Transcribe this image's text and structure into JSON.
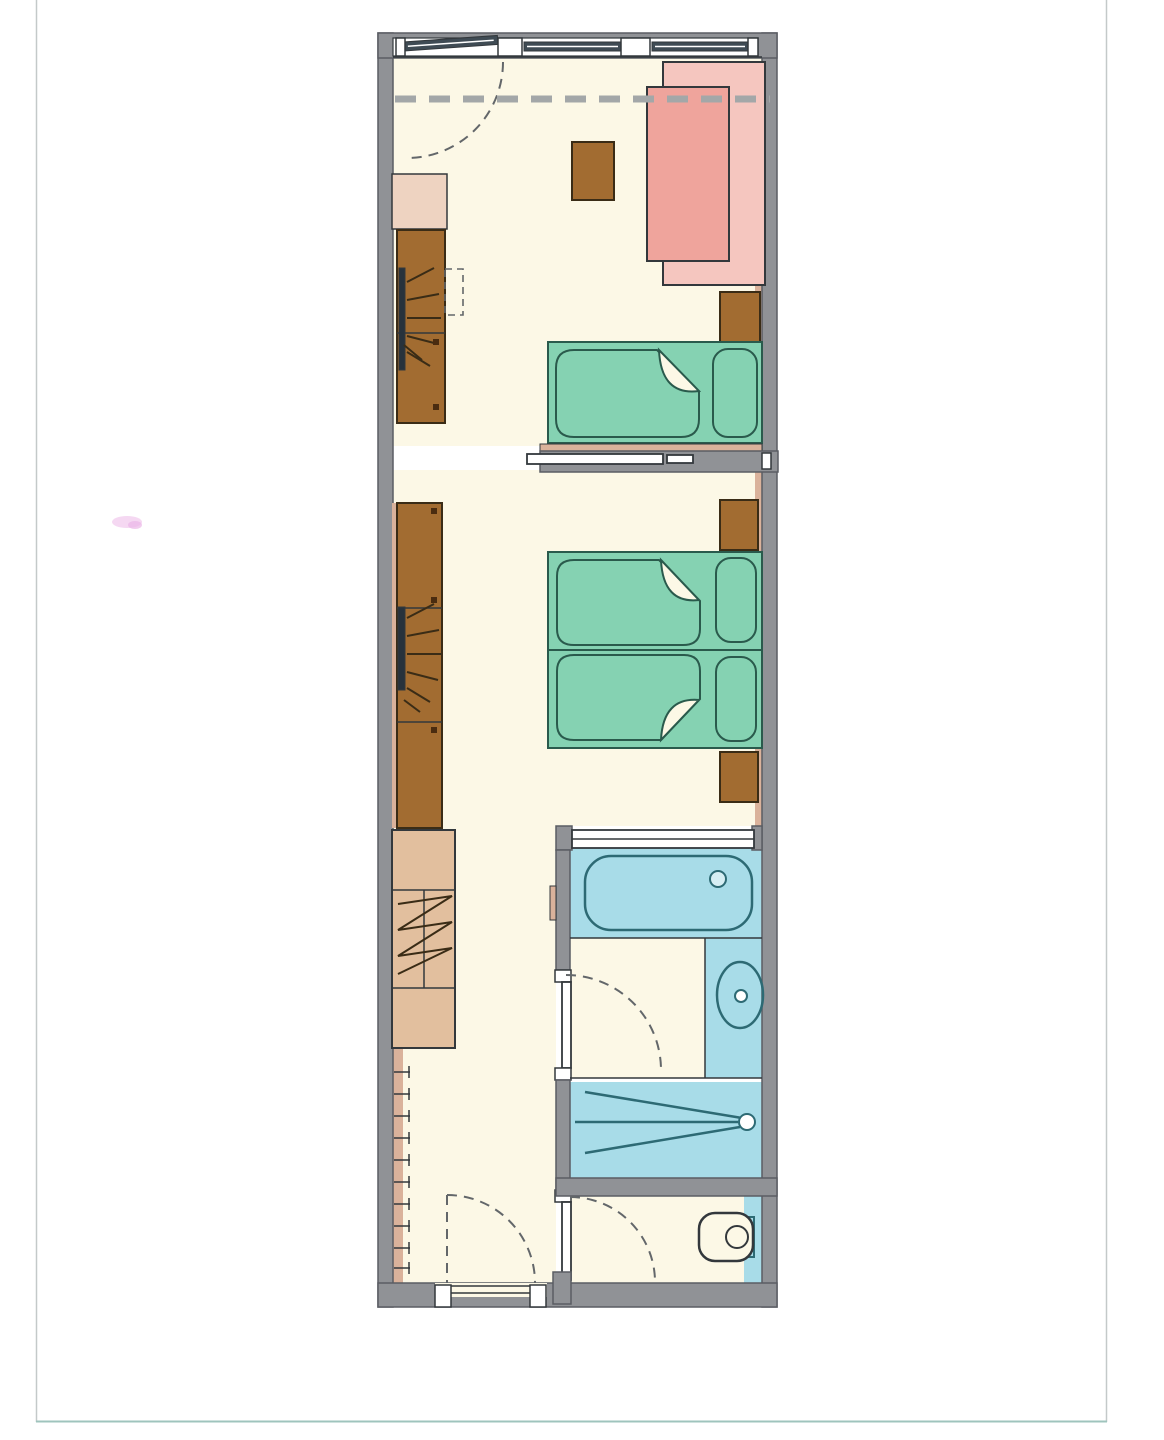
{
  "page": {
    "kind": "scanned-floor-plan",
    "background": "#ffffff",
    "frame_visible": true,
    "scan_smudge_present": true
  },
  "colors": {
    "paper": "#ffffff",
    "frame": "#c4c9c9",
    "frame_bottom": "#9fc4bd",
    "wall": "#909296",
    "wall_stroke": "#5a5d63",
    "floor": "#fcf8e6",
    "liner": "#dab29b",
    "bed_green": "#85d2b2",
    "bed_stroke": "#2a5a4c",
    "sofa_back": "#f5c6bf",
    "sofa_seat": "#efa49c",
    "wood_brown": "#a26c31",
    "wood_stroke": "#3a2c16",
    "beige": "#e2bf9e",
    "beige_light": "#eed3c1",
    "bath_blue": "#a8dce8",
    "bath_stroke": "#2d6a74",
    "line_dark": "#33383c",
    "dash": "#63676a",
    "window_bar": "#3f4b54",
    "balcony_dash": "#a3a7a8",
    "rail_dark": "#27323c",
    "knob": "#4a2c10",
    "smudge": "#d86fd0"
  },
  "plan": {
    "type": "floor-plan",
    "orientation": "vertical-strip-unit",
    "rooms": [
      {
        "name": "living-room",
        "position": "top",
        "fixtures": [
          "balcony-door",
          "window",
          "window",
          "balcony-overhang-dashed-line",
          "sofa",
          "coffee-table",
          "single-bed",
          "nightstand",
          "wardrobe-cabinet",
          "wardrobe-with-hanging-rail",
          "fold-out-shelf"
        ]
      },
      {
        "name": "bedroom",
        "position": "middle",
        "fixtures": [
          "sliding-door",
          "double-bed",
          "nightstand",
          "nightstand",
          "wardrobe-with-hanging-rail"
        ]
      },
      {
        "name": "hallway",
        "position": "bottom-left",
        "fixtures": [
          "luggage-bench",
          "coat-hook-ticks",
          "entrance-door"
        ]
      },
      {
        "name": "bathroom",
        "position": "bottom-right",
        "fixtures": [
          "glazed-partition",
          "bathtub",
          "vanity-counter",
          "washbasin",
          "shower",
          "bathroom-door"
        ]
      },
      {
        "name": "wc",
        "position": "bottom-right-lower",
        "fixtures": [
          "toilet",
          "wc-door"
        ]
      }
    ]
  }
}
